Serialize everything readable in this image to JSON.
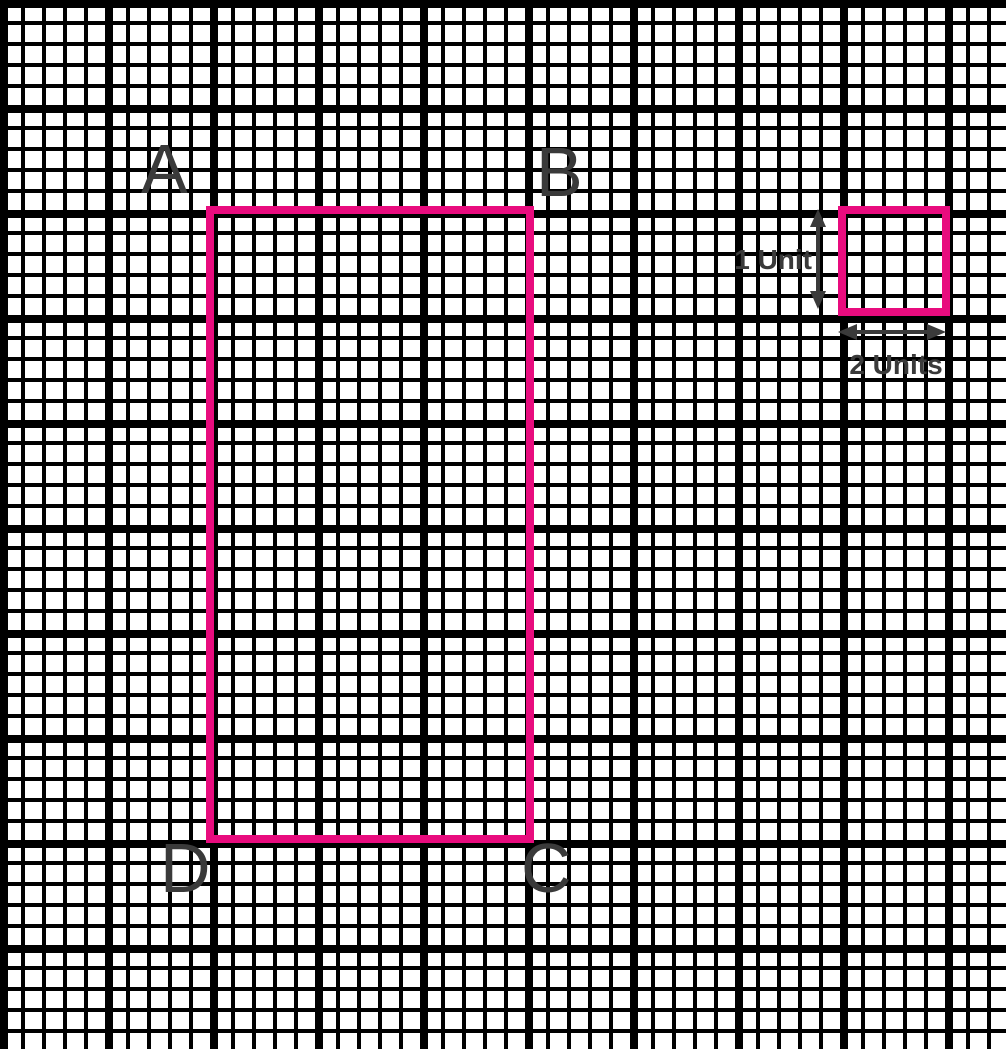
{
  "diagram": {
    "type": "grid-geometry-figure",
    "corner_labels": {
      "top_left": "A",
      "top_right": "B",
      "bottom_right": "C",
      "bottom_left": "D"
    },
    "scale_labels": {
      "vertical": "1 Unit",
      "horizontal": "2 Units"
    },
    "shapes": {
      "main_rectangle": {
        "corner_order": [
          "A",
          "B",
          "C",
          "D"
        ],
        "width_major_squares": 3,
        "height_major_squares": 6
      },
      "reference_square": {
        "width_label": "2 Units",
        "height_label": "1 Unit",
        "width_major_squares": 1,
        "height_major_squares": 1
      }
    },
    "colors": {
      "shape_outline": "#E80C7E",
      "grid_lines": "#000000",
      "background": "#FFFFFF",
      "annotation_text": "#3A3A3A"
    }
  }
}
